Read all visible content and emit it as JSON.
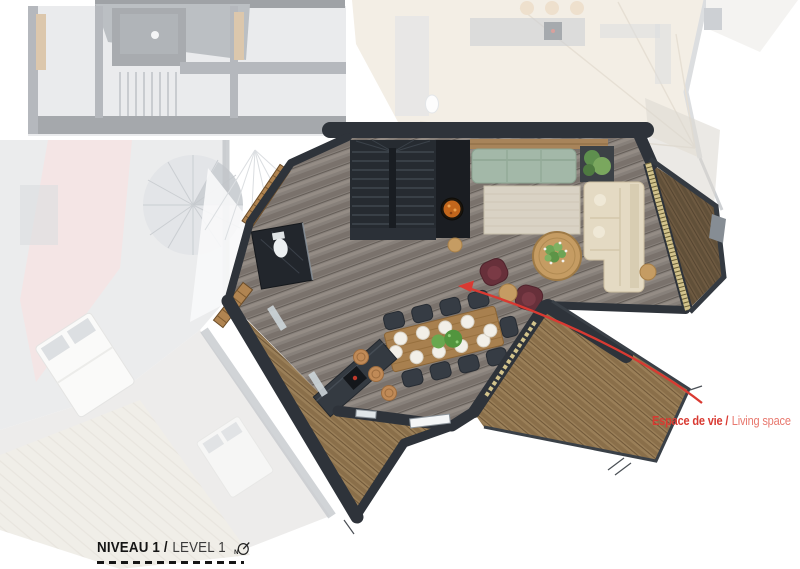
{
  "document": {
    "type": "architectural-floor-plan",
    "view": "level-plan-top-view"
  },
  "annotation": {
    "label_primary": "Espace de vie /",
    "label_secondary": "Living space",
    "primary_color": "#d93a32",
    "secondary_color": "#e8786e",
    "arrow_color": "#d93a32",
    "arrow_icon": "curved-red-arrow"
  },
  "title_block": {
    "level_primary": "NIVEAU 1 /",
    "level_secondary": "LEVEL 1",
    "north_letter": "N",
    "north_icon": "north-arrow-compass",
    "text_color": "#141414",
    "secondary_text_color": "#3a3a3a",
    "underline_style": "dashed"
  },
  "palette": {
    "interior_floor_wood": "#87807a",
    "terrace_deck": "#9a7f58",
    "balcony_deck_dark": "#6e5a41",
    "walls_dark": "#2e333a",
    "sofa_green": "#a3b8a8",
    "sofa_cream": "#e4dac3",
    "rug_beige": "#d9d2c4",
    "armchair_burgundy": "#67303a",
    "dining_table_wood": "#a8804f",
    "cork_stool": "#c08a57",
    "fireplace_fire": "#c2661c",
    "glazing_frame": "#d2c38c",
    "faded_roof_beige": "#e7ddcb",
    "faded_room_pink": "#e9caca"
  }
}
